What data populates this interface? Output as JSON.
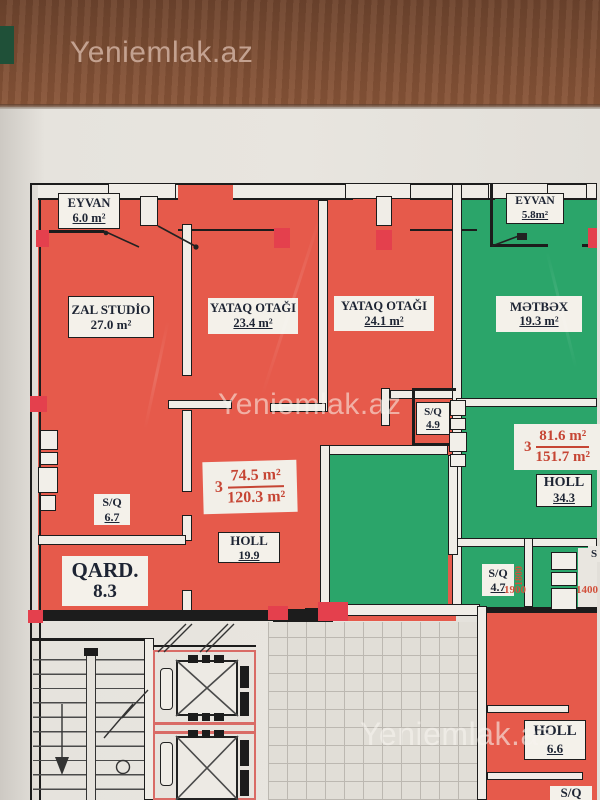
{
  "photo": {
    "watermark": "Yeniemlak.az"
  },
  "red_apartment": {
    "eyvan": {
      "name": "EYVAN",
      "area": "6.0 m²"
    },
    "zal": {
      "name": "ZAL  STUDİO",
      "area": "27.0 m²"
    },
    "yataq1": {
      "name": "YATAQ OTAĞI",
      "area": "23.4  m²"
    },
    "yataq2": {
      "name": "YATAQ OTAĞI",
      "area": "24.1 m²"
    },
    "sq_49": {
      "name": "S/Q",
      "area": "4.9"
    },
    "sq_67": {
      "name": "S/Q",
      "area": "6.7"
    },
    "qard": {
      "name": "QARD.",
      "area": "8.3"
    },
    "holl": {
      "name": "HOLL",
      "area": "19.9"
    },
    "summary": {
      "rooms": "3",
      "living_area": "74.5 m²",
      "total_area": "120.3 m²"
    }
  },
  "green_apartment": {
    "eyvan": {
      "name": "EYVAN",
      "area": "5.8m²"
    },
    "metbex": {
      "name": "MƏTBƏX",
      "area": "19.3 m²"
    },
    "holl": {
      "name": "HOLL",
      "area": "34.3"
    },
    "sq_47": {
      "name": "S/Q",
      "area": "4.7"
    },
    "summary": {
      "rooms": "3",
      "living_area": "81.6 m²",
      "total_area": "151.7 m²"
    },
    "dimensions": {
      "w1": "1800",
      "w2": "1900",
      "w3": "1400"
    },
    "sq_partial": "S"
  },
  "bottom_apartment": {
    "holl": {
      "name": "HOLL",
      "area": "6.6"
    },
    "sq_partial": "S/Q"
  }
}
